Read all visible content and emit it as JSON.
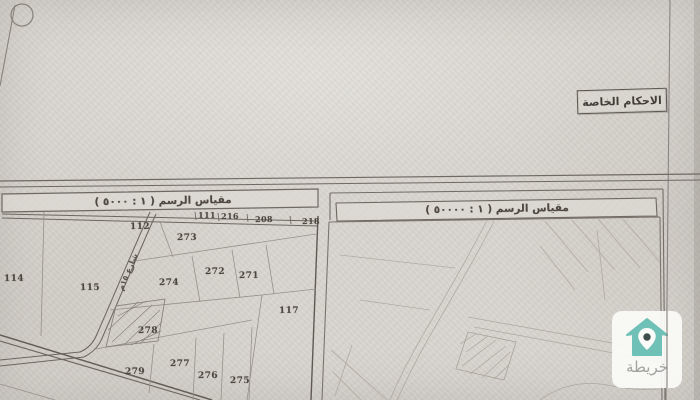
{
  "document": {
    "provisions_box_label": "الاحكام الخاصة",
    "left_panel": {
      "scale_label": "مقياس الرسم ( ١ : ٥٠٠٠ )"
    },
    "right_panel": {
      "scale_label": "مقياس الرسم ( ١ : ٥٠٠٠٠ )"
    }
  },
  "map_left": {
    "road_label": "شارع ١٥م",
    "plots": [
      {
        "label": "111"
      },
      {
        "label": "216"
      },
      {
        "label": "208"
      },
      {
        "label": "218"
      },
      {
        "label": "112"
      },
      {
        "label": "273"
      },
      {
        "label": "114"
      },
      {
        "label": "115"
      },
      {
        "label": "274"
      },
      {
        "label": "272"
      },
      {
        "label": "271"
      },
      {
        "label": "117"
      },
      {
        "label": "278"
      },
      {
        "label": "279"
      },
      {
        "label": "277"
      },
      {
        "label": "276"
      },
      {
        "label": "275"
      }
    ]
  },
  "watermark": {
    "brand": "خريطة",
    "colors": {
      "house": "#6fc0b6",
      "pin_dot": "#3f4d4b",
      "card": "#fbfbf9",
      "text": "#a2a2a0"
    }
  }
}
